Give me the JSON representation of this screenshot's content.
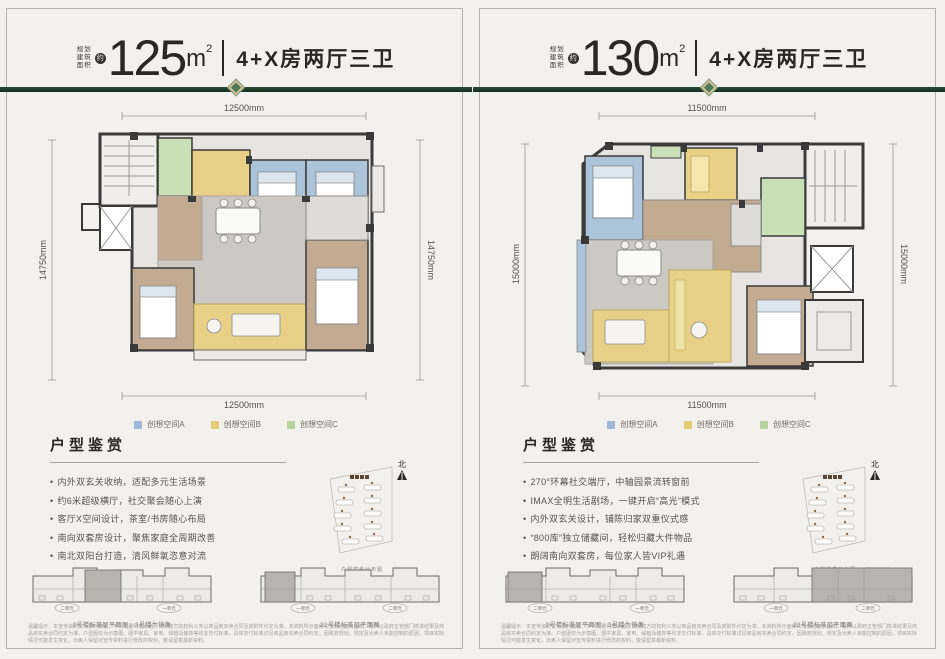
{
  "colors": {
    "background": "#f3f1ed",
    "accent_green_line": "#14301f",
    "diamond_green": "#4f7a55",
    "diamond_border": "#cdbd94",
    "legend_a_blue": "#9fb8d6",
    "legend_b_yellow": "#e4cc74",
    "legend_c_green": "#b7d3a0",
    "text_dark": "#2b2722"
  },
  "panels": [
    {
      "area_label_lines": [
        "规划",
        "建筑",
        "面积"
      ],
      "approx_symbol": "约",
      "area_value": "125",
      "area_unit": "m",
      "area_unit_exp": "2",
      "layout_text": "4+X房两厅三卫",
      "dims": {
        "top": "12500mm",
        "bottom": "12500mm",
        "left": "14750mm",
        "right": "14750mm"
      },
      "legend": [
        {
          "label": "创想空间A",
          "color": "#9fb8d6"
        },
        {
          "label": "创想空间B",
          "color": "#e4cc74"
        },
        {
          "label": "创想空间C",
          "color": "#b7d3a0"
        }
      ],
      "section_title": "户型鉴赏",
      "bullets": [
        "内外双玄关收纳，适配多元生活场景",
        "约6米超级横厅，社交聚会随心上演",
        "客厅X空间设计，茶室/书房随心布局",
        "南向双套房设计，聚焦家庭全周期改善",
        "南北双阳台打造，清风鲜氧恣意对流"
      ],
      "minimap": {
        "compass": "北",
        "caption": "户型楼栋分布图"
      },
      "plates": [
        {
          "units": [
            "二单元",
            "一单元"
          ],
          "caption": "2号楼标准层平面图，3号楼为镜像"
        },
        {
          "units": [
            "一单元",
            "二单元"
          ],
          "caption": "22号楼标准层平面图"
        }
      ],
      "disclaimer": "温馨提示：本宣传资料仅为要约邀请，不构成要约或承诺，买卖双方的权利义务以商品房买卖合同及其附件约定为准。本资料所示面积均为规划建筑面积，最终以政府主管部门核准结果及商品房买卖合同约定为准。户型图仅为示意图，图中家具、家电、绿植及装饰等均非交付标准，具体交付标准详见商品房买卖合同约定。因政府规划、规定及出卖人未能控制的原因，项目实际情况可能发生变化，出卖人保留对宣传资料进行修改的权利，敬请留意最新资料。"
    },
    {
      "area_label_lines": [
        "规划",
        "建筑",
        "面积"
      ],
      "approx_symbol": "约",
      "area_value": "130",
      "area_unit": "m",
      "area_unit_exp": "2",
      "layout_text": "4+X房两厅三卫",
      "dims": {
        "top": "11500mm",
        "bottom": "11500mm",
        "left": "15000mm",
        "right": "15000mm"
      },
      "legend": [
        {
          "label": "创想空间A",
          "color": "#9fb8d6"
        },
        {
          "label": "创想空间B",
          "color": "#e4cc74"
        },
        {
          "label": "创想空间C",
          "color": "#b7d3a0"
        }
      ],
      "section_title": "户型鉴赏",
      "bullets": [
        "270°环幕社交端厅，中轴园景流转窗前",
        "IMAX全明生活剧场，一键开启“高光”模式",
        "内外双玄关设计，铺陈归家双重仪式感",
        "“800库”独立储藏间，轻松归藏大件物品",
        "朗阔南向双套房，每位家人皆VIP礼遇"
      ],
      "minimap": {
        "compass": "北",
        "caption": "户型楼栋分布图"
      },
      "plates": [
        {
          "units": [
            "二单元",
            "一单元"
          ],
          "caption": "2号楼标准层平面图，3号楼为镜像"
        },
        {
          "units": [
            "一单元",
            "二单元"
          ],
          "caption": "22号楼标准层平面图"
        }
      ],
      "disclaimer": "温馨提示：本宣传资料仅为要约邀请，不构成要约或承诺，买卖双方的权利义务以商品房买卖合同及其附件约定为准。本资料所示面积均为规划建筑面积，最终以政府主管部门核准结果及商品房买卖合同约定为准。户型图仅为示意图，图中家具、家电、绿植及装饰等均非交付标准，具体交付标准详见商品房买卖合同约定。因政府规划、规定及出卖人未能控制的原因，项目实际情况可能发生变化，出卖人保留对宣传资料进行修改的权利，敬请留意最新资料。"
    }
  ]
}
